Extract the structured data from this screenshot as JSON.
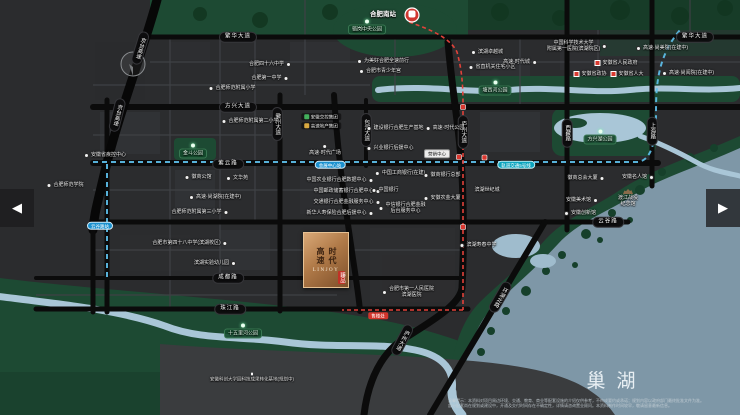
{
  "nav": {
    "left": "◀",
    "right": "▶"
  },
  "map": {
    "lake_name": "巢湖",
    "disclaimer": {
      "l1": "温馨提示：本资料对项目周边环境、交通、教育、商业等配套设施的介绍仅供参考，不构成要约或承诺；规划内容以政府部门最终批准文件为准。",
      "l2": "部分配套尚在规划或建设中，开通及交付时间存在不确定性，详情请咨询置业顾问。本资料制作时间较早，敬请留意最新信息。"
    },
    "logo": {
      "col1": "高速",
      "col2": "时代",
      "en": "LINJOY",
      "seal": "臻品"
    },
    "hub": {
      "x": 383,
      "y": 15,
      "t": "合肥南站"
    },
    "roads": [
      {
        "x": 238,
        "y": 37,
        "t": "繁华大道"
      },
      {
        "x": 695,
        "y": 37,
        "t": "繁华大道"
      },
      {
        "x": 238,
        "y": 107,
        "t": "方兴大道"
      },
      {
        "x": 228,
        "y": 164,
        "t": "紫云路"
      },
      {
        "x": 608,
        "y": 222,
        "t": "云谷路"
      },
      {
        "x": 228,
        "y": 278,
        "t": "成都路"
      },
      {
        "x": 230,
        "y": 309,
        "t": "珠江路"
      },
      {
        "x": 277,
        "y": 124,
        "t": "徽州大道",
        "v": 1
      },
      {
        "x": 366,
        "y": 130,
        "t": "包河大道",
        "v": 1
      },
      {
        "x": 463,
        "y": 132,
        "t": "庐州大道",
        "v": 1
      },
      {
        "x": 567,
        "y": 133,
        "t": "西藏路",
        "v": 1
      },
      {
        "x": 652,
        "y": 131,
        "t": "上海路",
        "v": 1
      },
      {
        "x": 500,
        "y": 297,
        "t": "环湖北路",
        "v": 1,
        "r": 30
      },
      {
        "x": 402,
        "y": 340,
        "t": "庐州大道",
        "v": 1,
        "r": 28
      },
      {
        "x": 140,
        "y": 48,
        "t": "京台高速",
        "v": 1,
        "r": 17
      },
      {
        "x": 117,
        "y": 115,
        "t": "京台高速",
        "v": 1,
        "r": 14
      }
    ],
    "stations": [
      {
        "x": 330,
        "y": 165,
        "t": "会展中心站"
      },
      {
        "x": 100,
        "y": 226,
        "t": "云谷路站"
      }
    ],
    "line_labels": [
      {
        "x": 516,
        "y": 165,
        "t": "轨道交通5号线"
      }
    ],
    "parks": [
      {
        "x": 367,
        "y": 27,
        "t": "骆岗中央公园"
      },
      {
        "x": 193,
        "y": 151,
        "t": "金斗公园"
      },
      {
        "x": 495,
        "y": 88,
        "t": "塘西河公园"
      },
      {
        "x": 600,
        "y": 137,
        "t": "方兴湖公园"
      },
      {
        "x": 243,
        "y": 331,
        "t": "十五里河公园"
      }
    ],
    "gov": [
      {
        "x": 616,
        "y": 63,
        "t": "安徽省人民政府"
      },
      {
        "x": 590,
        "y": 74,
        "t": "安徽省政协"
      },
      {
        "x": 627,
        "y": 74,
        "t": "安徽省人大"
      }
    ],
    "pois": [
      {
        "x": 270,
        "y": 64,
        "t": "合肥四十六中学",
        "i": "r"
      },
      {
        "x": 270,
        "y": 78,
        "t": "合肥第一中学",
        "i": "r"
      },
      {
        "x": 232,
        "y": 88,
        "t": "合肥师范附属小学",
        "i": "l"
      },
      {
        "x": 250,
        "y": 121,
        "t": "合肥师范附属第二小学",
        "i": "l"
      },
      {
        "x": 383,
        "y": 61,
        "t": "为美好合肥全速前行",
        "i": "l"
      },
      {
        "x": 380,
        "y": 71,
        "t": "合肥市青少年宫",
        "i": "l"
      },
      {
        "x": 487,
        "y": 52,
        "t": "滨湖卓越城",
        "i": "l"
      },
      {
        "x": 492,
        "y": 67,
        "t": "省直机关住宅小区",
        "i": "l"
      },
      {
        "x": 577,
        "y": 46,
        "lines": [
          "中国科学技术大学",
          "附属第一医院(滨湖院区)"
        ],
        "i": "r"
      },
      {
        "x": 662,
        "y": 48,
        "t": "高速·尚美院(在建中)",
        "i": "l"
      },
      {
        "x": 688,
        "y": 73,
        "t": "高速·尚阅院(在建中)",
        "i": "l"
      },
      {
        "x": 105,
        "y": 155,
        "t": "安徽省疾控中心",
        "i": "l"
      },
      {
        "x": 65,
        "y": 185,
        "t": "合肥师范学院",
        "i": "l"
      },
      {
        "x": 198,
        "y": 177,
        "t": "徽商公馆",
        "i": "l"
      },
      {
        "x": 237,
        "y": 178,
        "t": "文华苑",
        "i": "l"
      },
      {
        "x": 215,
        "y": 197,
        "t": "高速·尚湖院(在建中)",
        "i": "l"
      },
      {
        "x": 200,
        "y": 212,
        "t": "合肥师范附属第三小学",
        "i": "r"
      },
      {
        "x": 190,
        "y": 243,
        "t": "合肥市第四十八中学(滨湖校区)",
        "i": "r"
      },
      {
        "x": 215,
        "y": 263,
        "t": "滨湖实验幼儿园",
        "i": "r"
      },
      {
        "x": 340,
        "y": 180,
        "t": "中国农业银行合肥数据中心",
        "i": "r"
      },
      {
        "x": 347,
        "y": 191,
        "t": "中国邮政储蓄银行合肥中心",
        "i": "r"
      },
      {
        "x": 347,
        "y": 202,
        "t": "交通银行合肥金融服务中心",
        "i": "r"
      },
      {
        "x": 340,
        "y": 213,
        "t": "新华人寿保险合肥后援中心",
        "i": "r"
      },
      {
        "x": 395,
        "y": 128,
        "t": "建设银行合肥生产基地",
        "i": "l"
      },
      {
        "x": 390,
        "y": 148,
        "t": "兴业银行后援中心",
        "i": "l"
      },
      {
        "x": 400,
        "y": 173,
        "t": "中国工商银行(在建)",
        "i": "l"
      },
      {
        "x": 385,
        "y": 190,
        "t": "中国银行",
        "i": "l"
      },
      {
        "x": 402,
        "y": 208,
        "lines": [
          "中信银行合肥金融",
          "后台服务中心"
        ],
        "i": "l"
      },
      {
        "x": 442,
        "y": 175,
        "t": "徽商银行总部",
        "i": "l"
      },
      {
        "x": 442,
        "y": 198,
        "t": "安徽农金大厦",
        "i": "l"
      },
      {
        "x": 487,
        "y": 190,
        "t": "滨湖世纪城",
        "i": "n"
      },
      {
        "x": 478,
        "y": 245,
        "t": "滨湖寿春中学",
        "i": "l"
      },
      {
        "x": 408,
        "y": 292,
        "lines": [
          "合肥市第一人民医院",
          "滨湖医院"
        ],
        "i": "l"
      },
      {
        "x": 586,
        "y": 178,
        "t": "徽商总会大厦",
        "i": "r"
      },
      {
        "x": 582,
        "y": 200,
        "t": "安徽美术馆",
        "i": "r"
      },
      {
        "x": 580,
        "y": 213,
        "t": "安徽创新馆",
        "i": "l"
      },
      {
        "x": 638,
        "y": 177,
        "t": "安徽名人馆",
        "i": "r"
      },
      {
        "x": 628,
        "y": 198,
        "lines": [
          "渡江战役",
          "纪念馆"
        ],
        "i": "n",
        "b": 1
      },
      {
        "x": 325,
        "y": 150,
        "t": "高速·时代广场",
        "i": "t"
      },
      {
        "x": 445,
        "y": 128,
        "t": "高速·时代公园",
        "i": "l"
      },
      {
        "x": 520,
        "y": 62,
        "t": "高速·时代城",
        "i": "r"
      }
    ],
    "brand": [
      {
        "x": 321,
        "y": 117,
        "t": "安徽交控集团",
        "c": "#43b05c"
      },
      {
        "x": 321,
        "y": 126,
        "t": "高速地产集团",
        "c": "#d9a940"
      }
    ],
    "boxes": [
      {
        "x": 437,
        "y": 154,
        "t": "营销中心",
        "s": "white"
      },
      {
        "x": 378,
        "y": 316,
        "t": "售楼处",
        "s": "red"
      }
    ],
    "smalls": [
      {
        "x": 252,
        "y": 377,
        "t": "安徽科创大学园科技成果转化基地(规划中)",
        "dot": true
      }
    ]
  }
}
